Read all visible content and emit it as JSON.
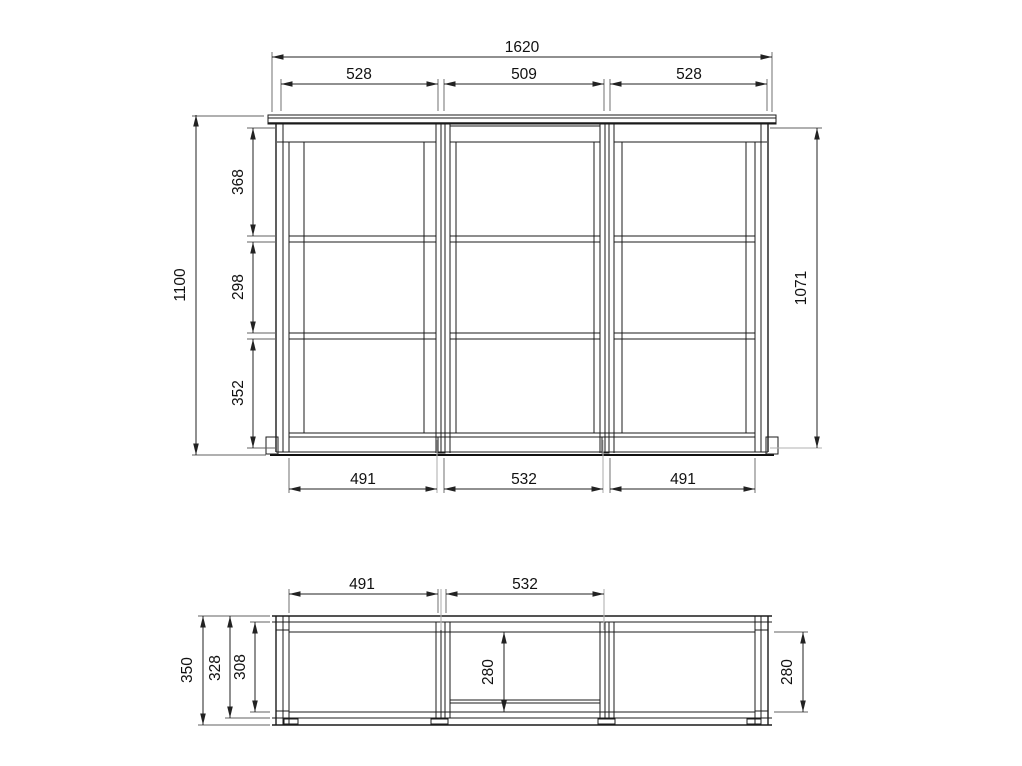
{
  "page": {
    "background": "#ffffff",
    "line_color": "#1b1b1b",
    "dim_line_color": "#222222",
    "ext_line_color": "#606060",
    "text_color": "#111111"
  },
  "front_view": {
    "overall_width": "1620",
    "top_section_widths": [
      "528",
      "509",
      "528"
    ],
    "overall_height": "1100",
    "left_interior_heights": [
      "368",
      "298",
      "352"
    ],
    "right_interior_height": "1071",
    "bottom_section_widths": [
      "491",
      "532",
      "491"
    ]
  },
  "plan_view": {
    "section_widths": [
      "491",
      "532"
    ],
    "left_depths": [
      "350",
      "328",
      "308"
    ],
    "center_interior_depth": "280",
    "right_interior_depth": "280"
  }
}
